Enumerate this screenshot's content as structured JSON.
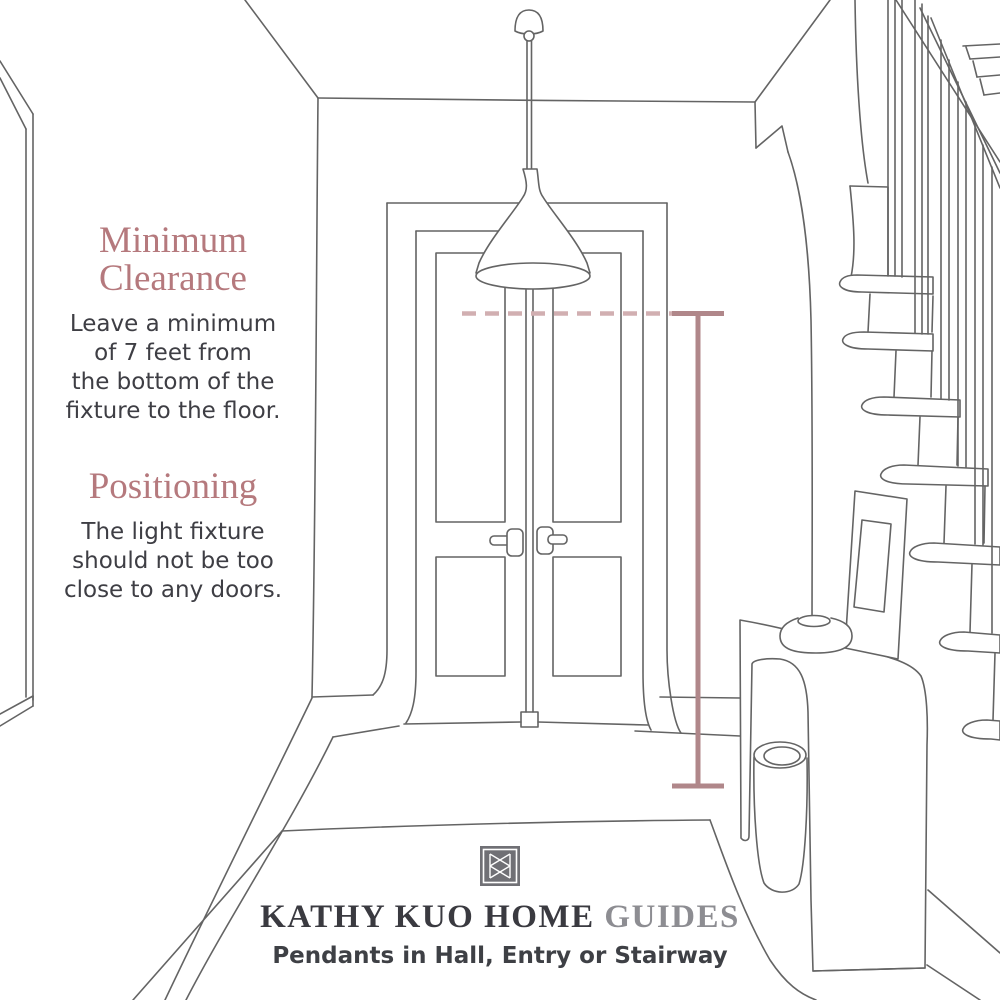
{
  "page": {
    "background": "#ffffff"
  },
  "sections": [
    {
      "title_lines": [
        "Minimum",
        "Clearance"
      ],
      "body_lines": [
        "Leave a minimum",
        "of 7 feet from",
        "the bottom of the",
        "fixture to the floor."
      ]
    },
    {
      "title_lines": [
        "Positioning"
      ],
      "body_lines": [
        "The light fixture",
        "should not be too",
        "close to any doors."
      ]
    }
  ],
  "footer": {
    "logo_icon": "kathy-kuo-home-monogram",
    "brand": "KATHY KUO HOME",
    "brand_suffix": "GUIDES",
    "subtitle": "Pendants in Hall, Entry or Stairway"
  },
  "illustration": {
    "scene": "hand-drawn hallway with pendant light over entry, double door, staircase and console table",
    "measurement_note": "vertical measure line from pendant bottom clearance level to floor"
  },
  "colors": {
    "heading_rose": "#b5797d",
    "body_text": "#3e3e44",
    "brand_text": "#3a3a40",
    "guides_text": "#8d8d92",
    "subtitle_text": "#3e4045",
    "logo_gray": "#707075",
    "sketch_line": "#4f4f4f",
    "dashed_line": "#cba4a7",
    "measure_line": "#a6777a"
  }
}
